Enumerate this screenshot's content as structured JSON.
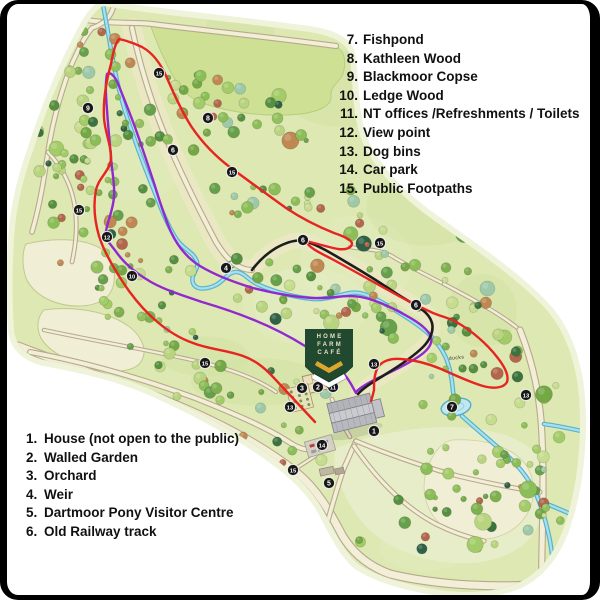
{
  "legend_top_right": {
    "items": [
      {
        "num": "7.",
        "label": "Fishpond"
      },
      {
        "num": "8.",
        "label": "Kathleen Wood"
      },
      {
        "num": "9.",
        "label": "Blackmoor Copse"
      },
      {
        "num": "10.",
        "label": "Ledge Wood"
      },
      {
        "num": "11.",
        "label": "NT offices /Refreshments / Toilets"
      },
      {
        "num": "12.",
        "label": "View point"
      },
      {
        "num": "13.",
        "label": "Dog bins"
      },
      {
        "num": "14.",
        "label": "Car park"
      },
      {
        "num": "15.",
        "label": "Public Footpaths"
      }
    ]
  },
  "legend_bottom_left": {
    "items": [
      {
        "num": "1.",
        "label": "House (not open to the public)"
      },
      {
        "num": "2.",
        "label": "Walled Garden"
      },
      {
        "num": "3.",
        "label": "Orchard"
      },
      {
        "num": "4.",
        "label": "Weir"
      },
      {
        "num": "5.",
        "label": "Dartmoor Pony Visitor Centre"
      },
      {
        "num": "6.",
        "label": "Old Railway track"
      }
    ]
  },
  "cafe_sign": {
    "line1": "HOME",
    "line2": "FARM",
    "line3": "CAFÉ"
  },
  "map_labels": {
    "ducks": "ducks"
  },
  "map_markers": [
    {
      "n": "1",
      "x": 374,
      "y": 431
    },
    {
      "n": "2",
      "x": 318,
      "y": 387
    },
    {
      "n": "3",
      "x": 302,
      "y": 388
    },
    {
      "n": "4",
      "x": 226,
      "y": 268
    },
    {
      "n": "5",
      "x": 329,
      "y": 483
    },
    {
      "n": "6",
      "x": 173,
      "y": 150
    },
    {
      "n": "6",
      "x": 303,
      "y": 240
    },
    {
      "n": "6",
      "x": 416,
      "y": 305
    },
    {
      "n": "7",
      "x": 452,
      "y": 407
    },
    {
      "n": "8",
      "x": 208,
      "y": 118
    },
    {
      "n": "9",
      "x": 88,
      "y": 108
    },
    {
      "n": "10",
      "x": 132,
      "y": 276
    },
    {
      "n": "11",
      "x": 333,
      "y": 387
    },
    {
      "n": "12",
      "x": 107,
      "y": 237
    },
    {
      "n": "13",
      "x": 290,
      "y": 407
    },
    {
      "n": "13",
      "x": 374,
      "y": 364
    },
    {
      "n": "13",
      "x": 526,
      "y": 395
    },
    {
      "n": "14",
      "x": 322,
      "y": 445
    },
    {
      "n": "15",
      "x": 159,
      "y": 73
    },
    {
      "n": "15",
      "x": 79,
      "y": 210
    },
    {
      "n": "15",
      "x": 232,
      "y": 172
    },
    {
      "n": "15",
      "x": 380,
      "y": 243
    },
    {
      "n": "15",
      "x": 205,
      "y": 363
    },
    {
      "n": "15",
      "x": 293,
      "y": 470
    }
  ],
  "colors": {
    "trail_red": "#e62420",
    "trail_purple": "#9129ce",
    "trail_black": "#1d1d1d",
    "river_blue": "#56b4cb",
    "river_light": "#aadff0",
    "park_green": "#dde8b2",
    "park_halo": "#eef3da",
    "meadow_green": "#cde093",
    "field_cream": "#f1eed6",
    "road_fill": "#f3eed8",
    "road_edge": "#b7aa8b",
    "cafe_green": "#20492f",
    "cafe_gold": "#dca62f",
    "marker_black": "#171717"
  }
}
